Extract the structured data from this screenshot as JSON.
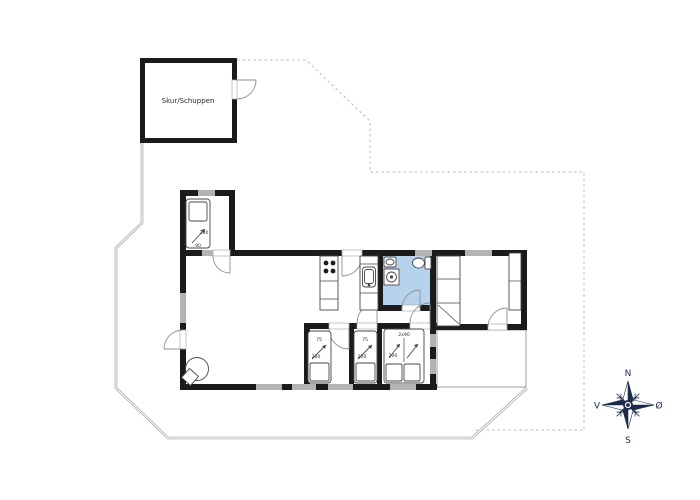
{
  "plan": {
    "shed_label": "Skur/Schuppen",
    "beds": {
      "nw": {
        "length": "200",
        "width": "90"
      },
      "single_1": {
        "width": "75",
        "length": "200"
      },
      "single_2": {
        "width": "75",
        "length": "200"
      },
      "double": {
        "size": "2x90",
        "length": "200"
      }
    },
    "compass": {
      "north": "N",
      "south": "S",
      "west": "V",
      "east": "Ø"
    },
    "colors": {
      "wall": "#1b1b1b",
      "window": "#b3b3b3",
      "bathroom": "#b7d2ec",
      "furniture": "#474747",
      "door": "#8f8f8f",
      "boundary": "#b8b8b8",
      "fence": "#9c9c9c",
      "compass": "#1c2b4c"
    }
  }
}
